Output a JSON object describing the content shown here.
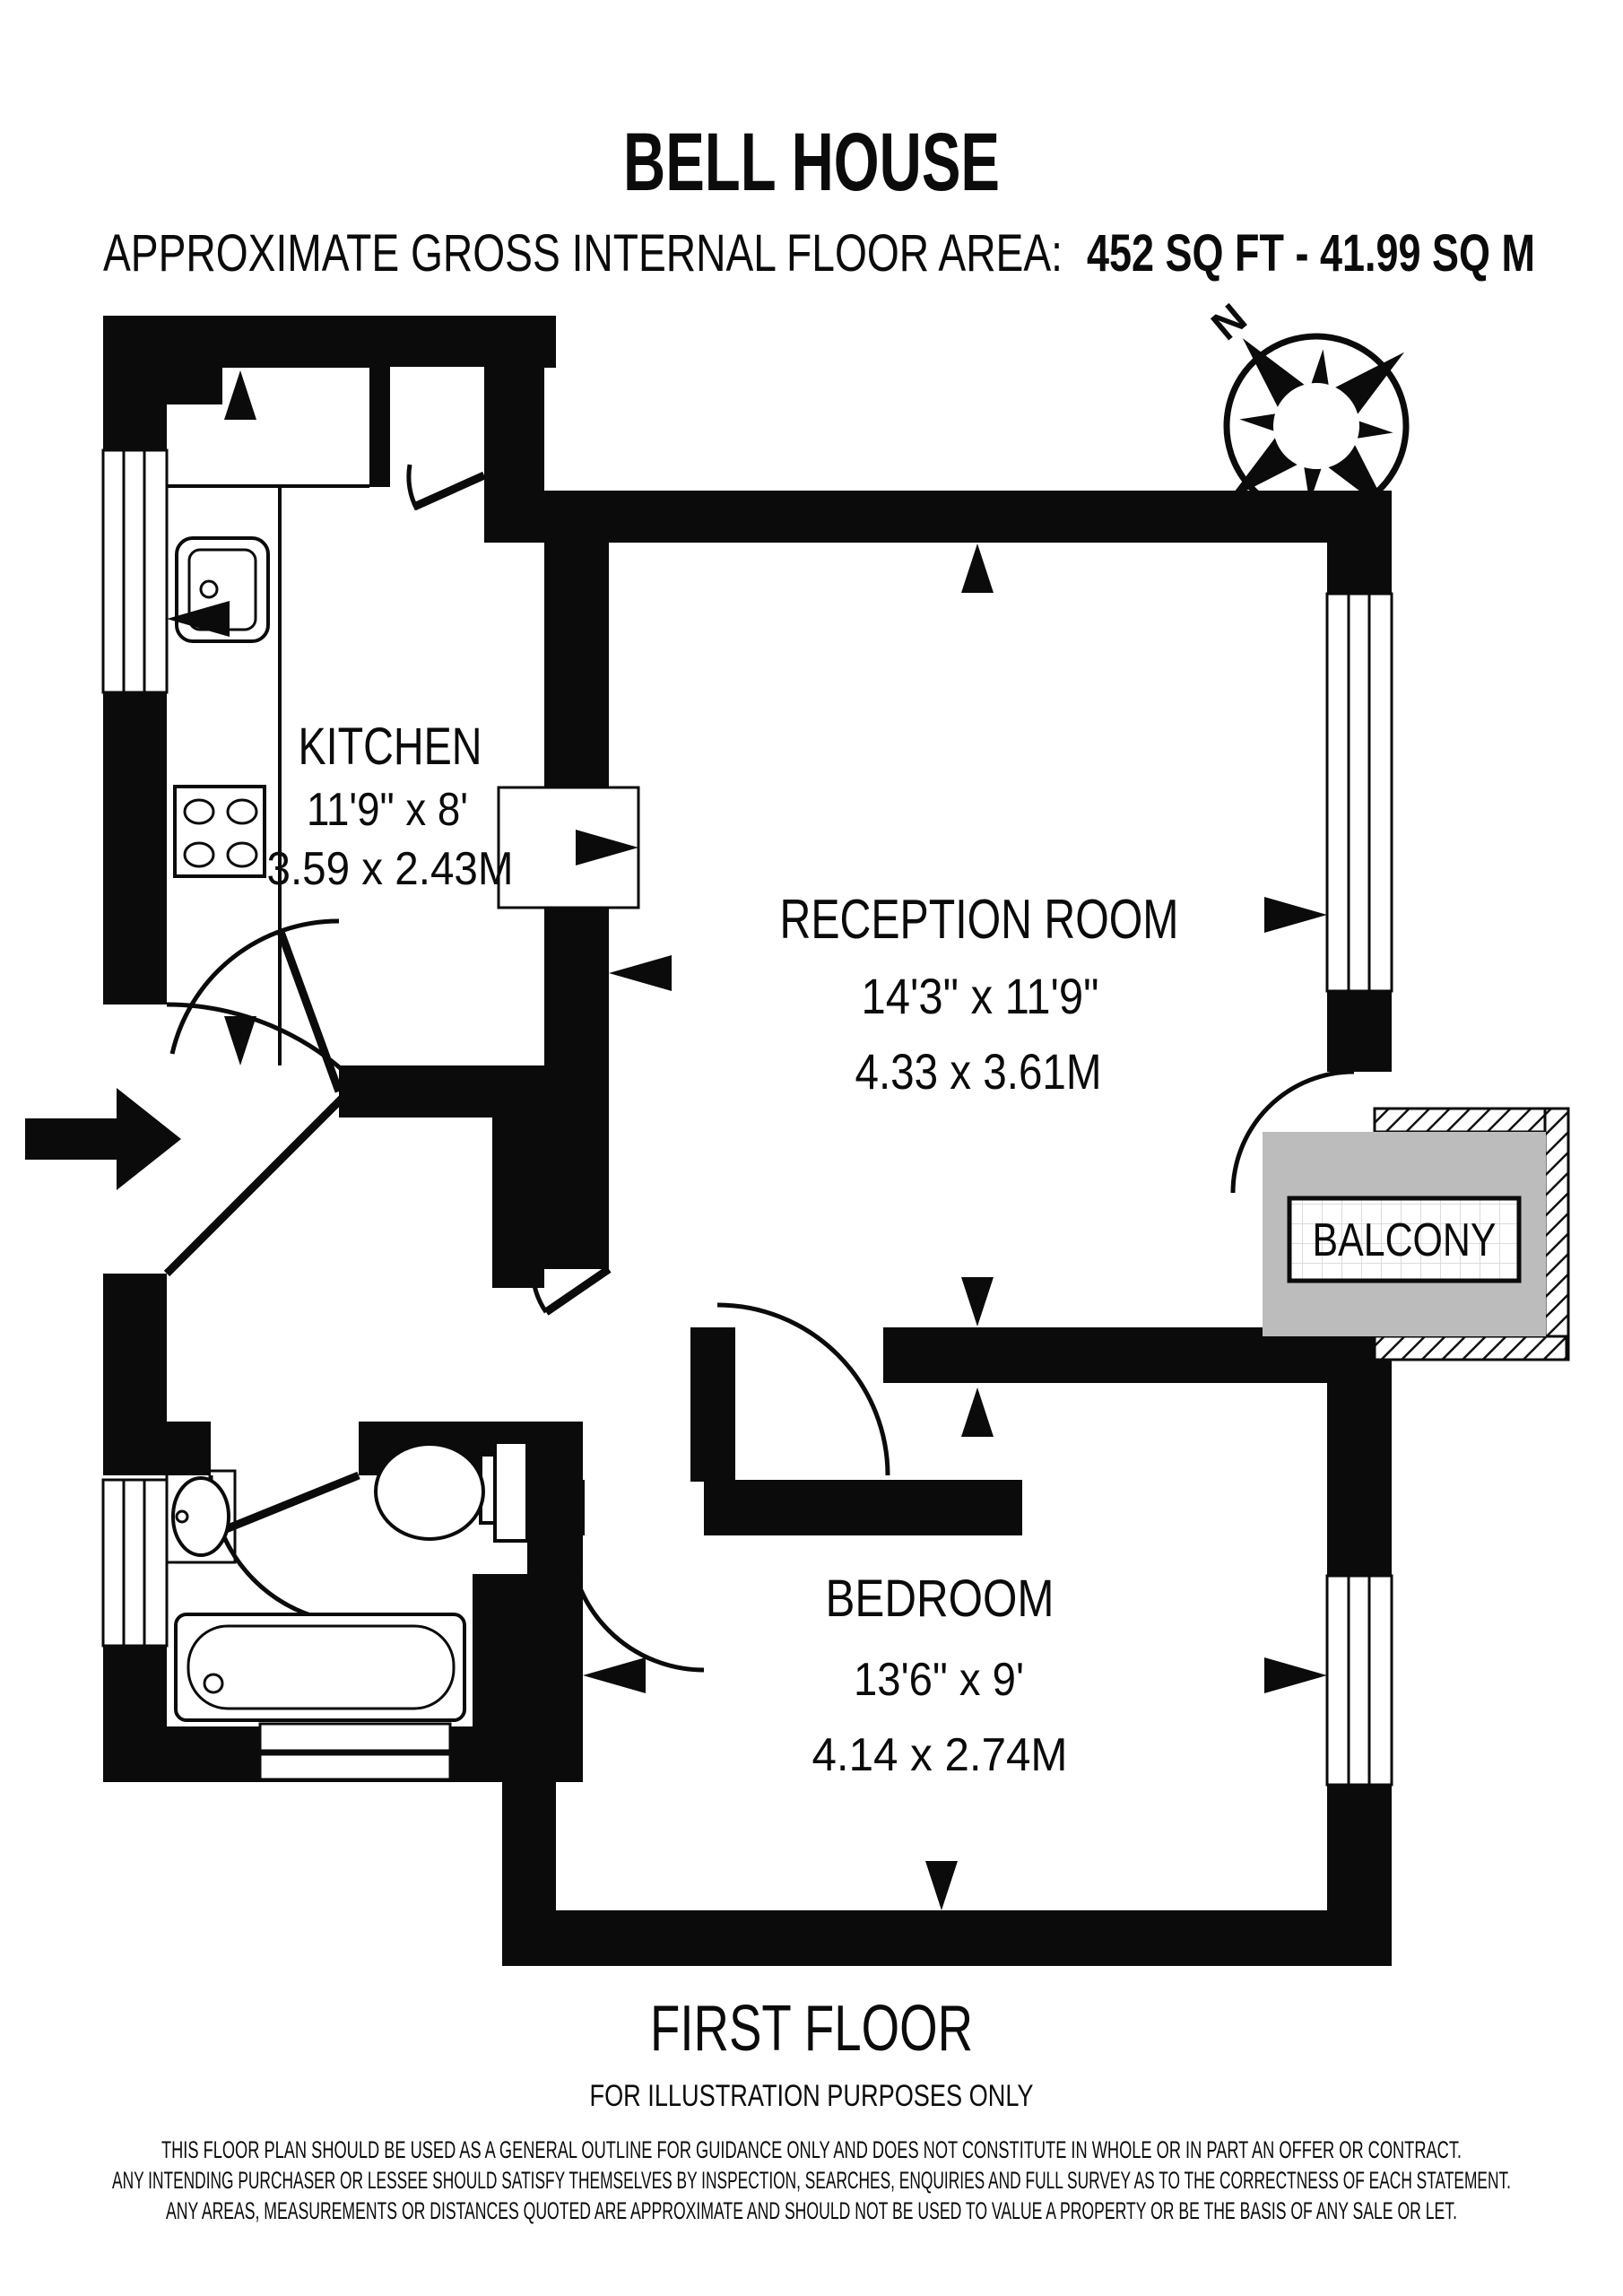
{
  "header": {
    "title": "BELL HOUSE",
    "area_label": "APPROXIMATE GROSS INTERNAL FLOOR AREA:",
    "area_value": "452 SQ FT - 41.99 SQ M"
  },
  "compass": {
    "north_label": "N"
  },
  "rooms": {
    "kitchen": {
      "name": "KITCHEN",
      "size_imperial": "11'9\" x 8'",
      "size_metric": "3.59 x 2.43M"
    },
    "reception": {
      "name": "RECEPTION ROOM",
      "size_imperial": "14'3\" x 11'9\"",
      "size_metric": "4.33 x 3.61M"
    },
    "bedroom": {
      "name": "BEDROOM",
      "size_imperial": "13'6\" x 9'",
      "size_metric": "4.14 x 2.74M"
    },
    "balcony": {
      "name": "BALCONY"
    }
  },
  "footer": {
    "floor_label": "FIRST FLOOR",
    "note": "FOR ILLUSTRATION PURPOSES ONLY",
    "disclaimer": [
      "THIS FLOOR PLAN SHOULD BE USED AS A GENERAL OUTLINE FOR GUIDANCE ONLY AND DOES NOT CONSTITUTE IN WHOLE OR IN PART AN OFFER OR CONTRACT.",
      "ANY INTENDING PURCHASER OR LESSEE SHOULD SATISFY THEMSELVES BY INSPECTION, SEARCHES, ENQUIRIES AND FULL SURVEY AS TO THE CORRECTNESS OF EACH STATEMENT.",
      "ANY AREAS, MEASUREMENTS OR DISTANCES QUOTED ARE APPROXIMATE AND SHOULD NOT BE USED TO VALUE A PROPERTY OR BE THE BASIS OF ANY SALE OR LET."
    ]
  },
  "colors": {
    "wall": "#0b0b0b",
    "balcony_fill": "#bcbcbc",
    "paper": "#ffffff"
  }
}
